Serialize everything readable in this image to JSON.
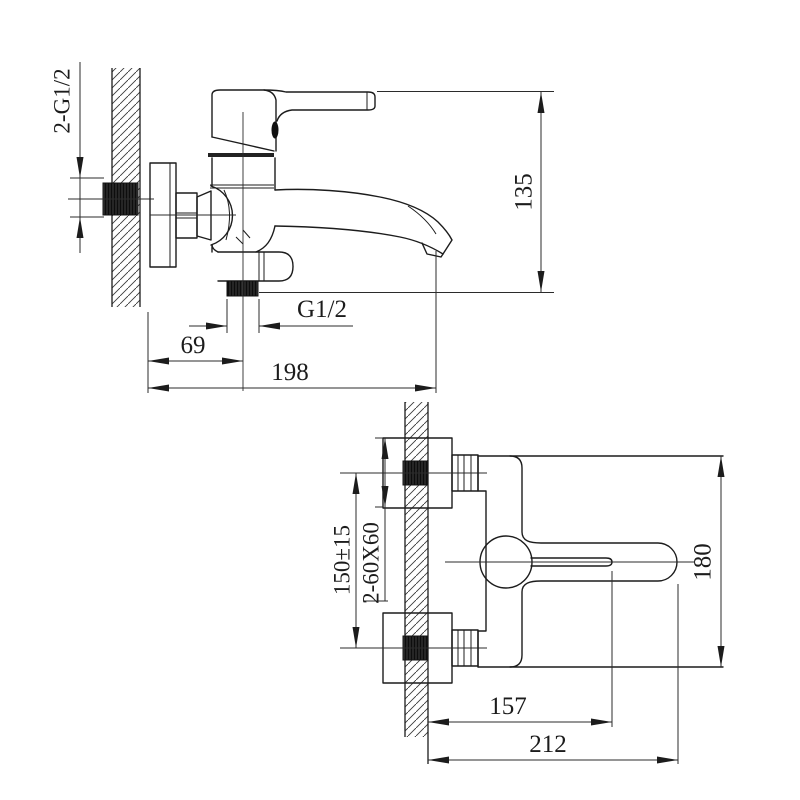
{
  "side_view": {
    "labels": {
      "wall_inlet_thread": "2-G1/2",
      "overall_height": "135",
      "shower_outlet_thread": "G1/2",
      "shower_outlet_offset": "69",
      "spout_reach": "198"
    }
  },
  "plan_view": {
    "labels": {
      "inlet_center_distance": "150±15",
      "mounting_block_size": "2-60X60",
      "body_depth": "180",
      "handle_pivot_reach": "157",
      "overall_reach": "212"
    }
  },
  "colors": {
    "line": "#1c1c1c",
    "background": "#ffffff",
    "hatch": "#3a3a3a"
  }
}
